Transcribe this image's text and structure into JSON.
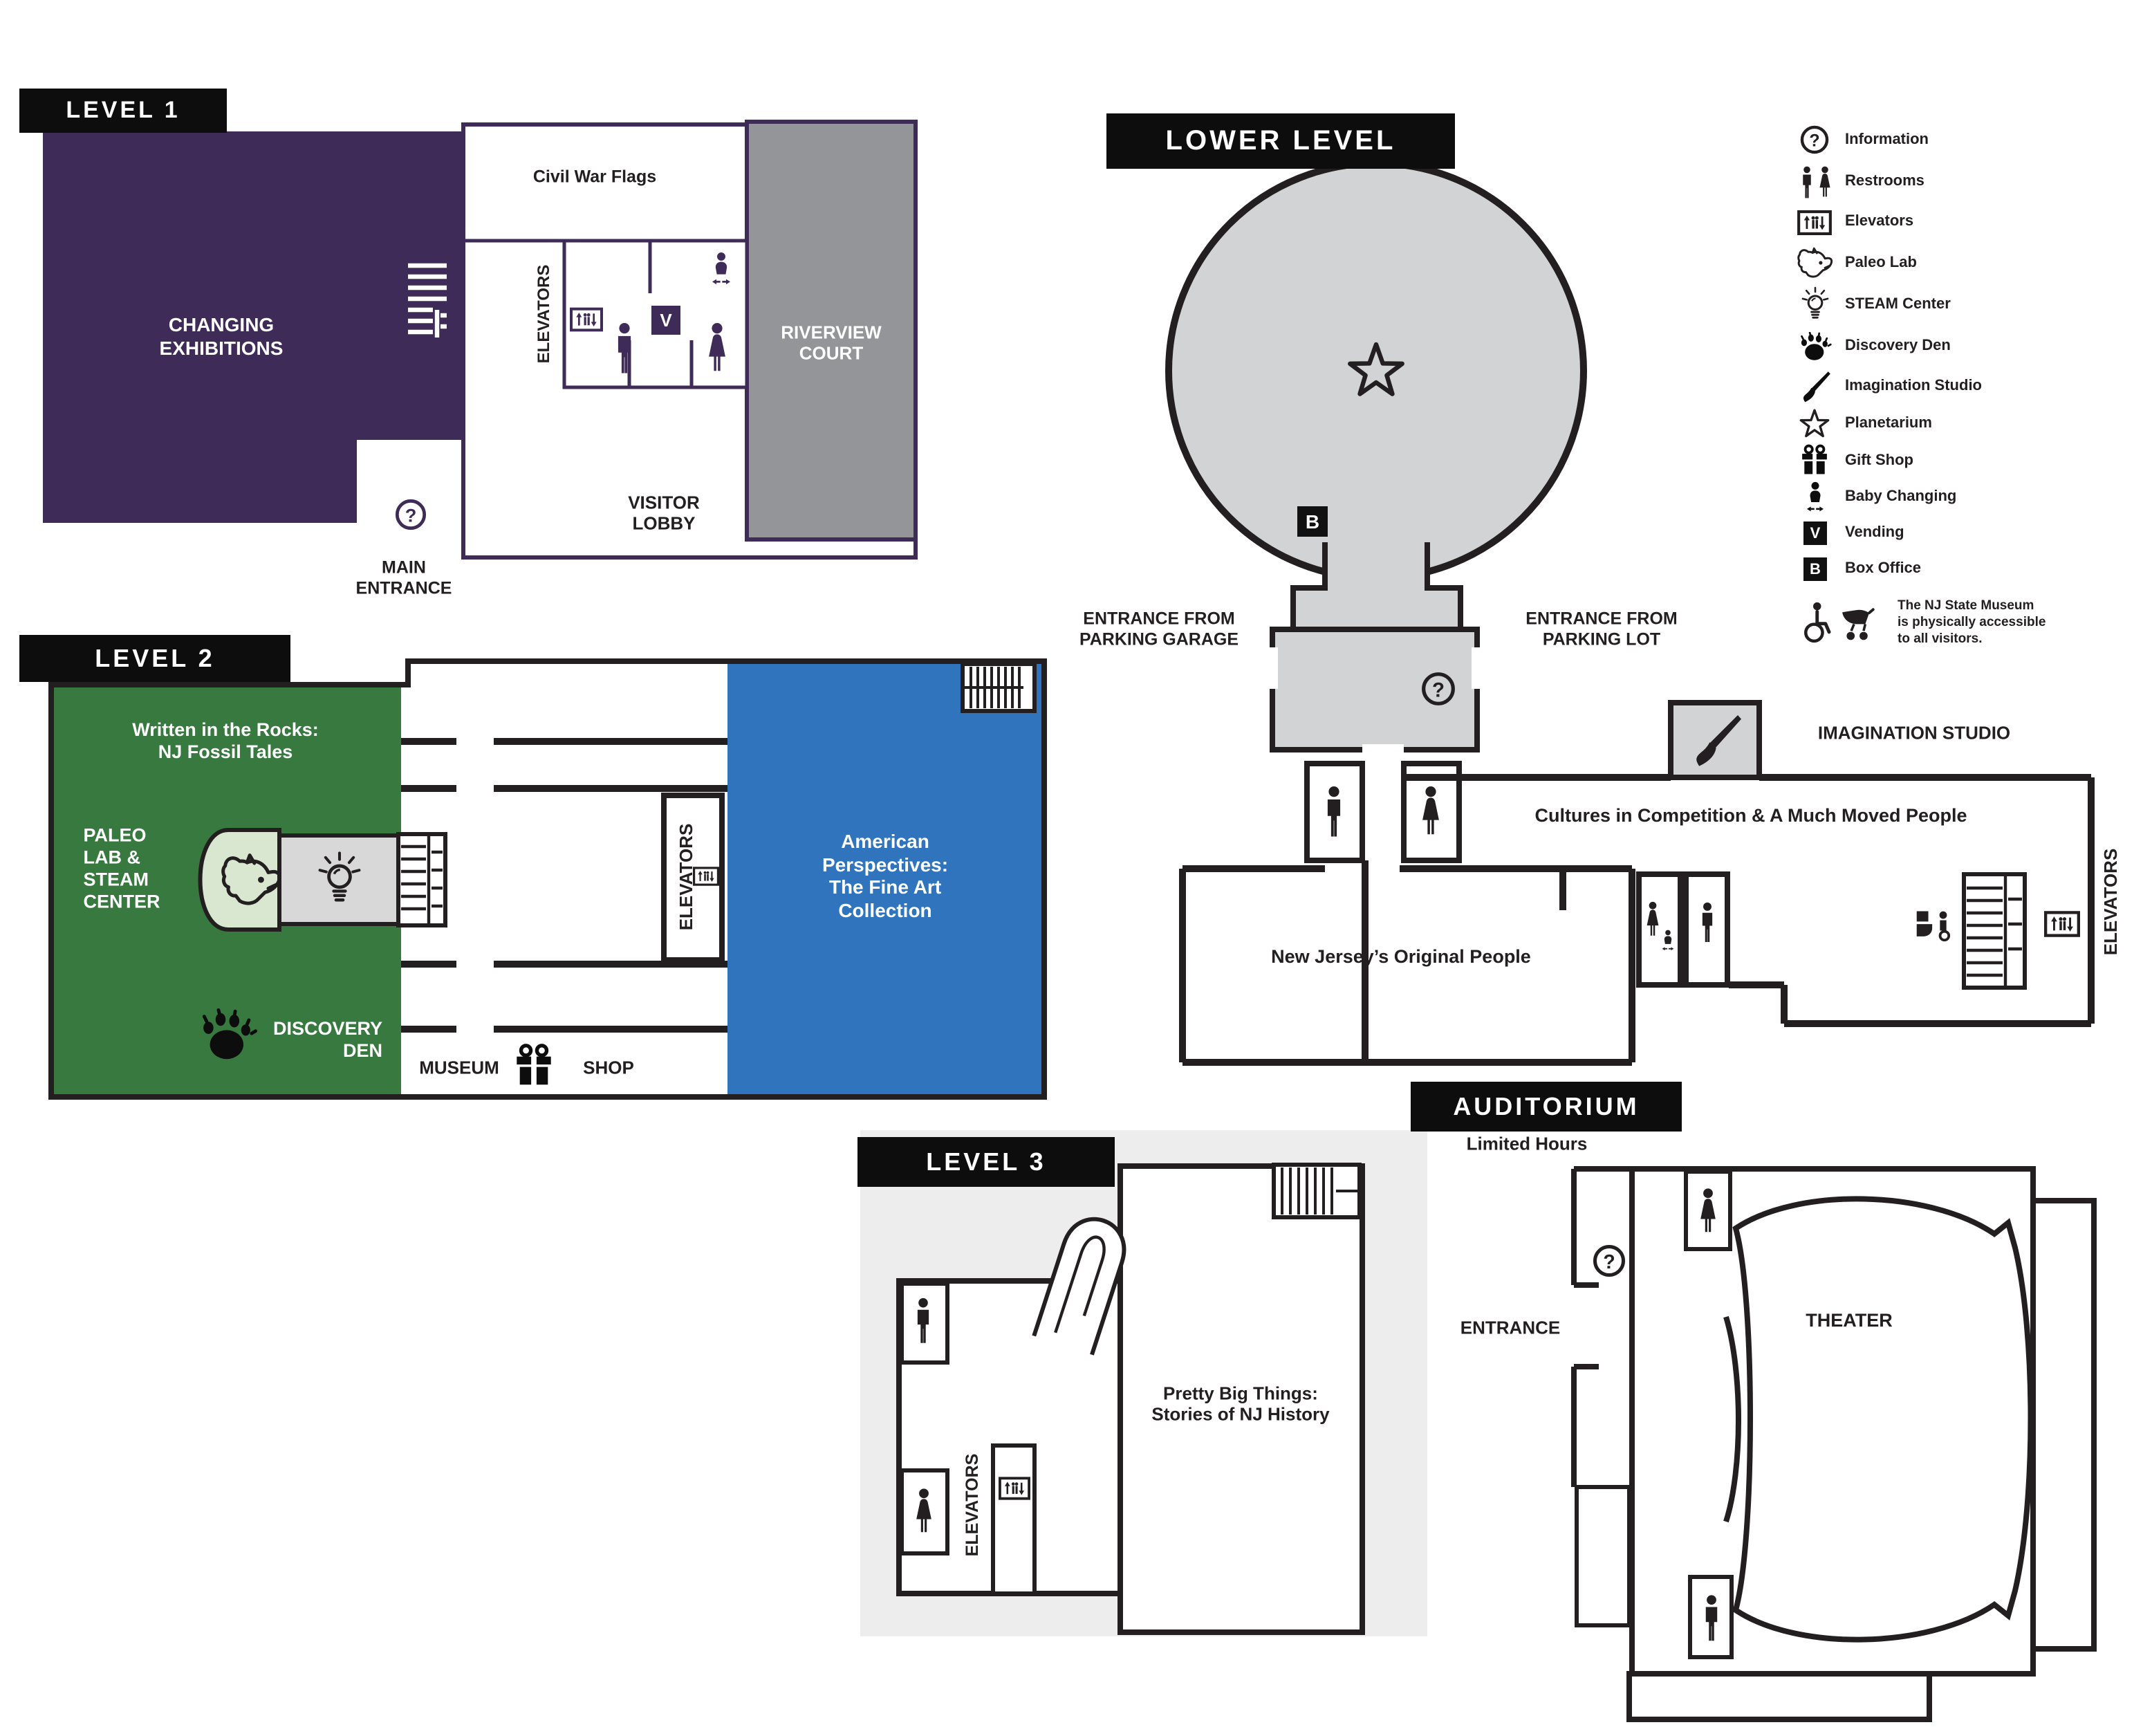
{
  "colors": {
    "purple": "#3F2B57",
    "green": "#37793F",
    "blue": "#2F74BC",
    "court_gray": "#949598",
    "light_gray": "#D2D3D4",
    "backdrop_gray": "#EDEDEE",
    "wall_black": "#231F20",
    "paleo_pill_green": "#D9E7D0",
    "steam_box_gray": "#D8D8D8"
  },
  "level1": {
    "title": "LEVEL 1",
    "changing_exhibitions": [
      "CHANGING",
      "EXHIBITIONS"
    ],
    "civil_war_flags": "Civil War Flags",
    "elevators": "ELEVATORS",
    "riverview_court": [
      "RIVERVIEW",
      "COURT"
    ],
    "visitor_lobby": [
      "VISITOR",
      "LOBBY"
    ],
    "main_entrance": [
      "MAIN",
      "ENTRANCE"
    ],
    "vending_letter": "V"
  },
  "level2": {
    "title": "LEVEL 2",
    "written_in_the_rocks": [
      "Written in the Rocks:",
      "NJ Fossil Tales"
    ],
    "paleo_lab_steam": [
      "PALEO",
      "LAB &",
      "STEAM",
      "CENTER"
    ],
    "discovery_den": [
      "DISCOVERY",
      "DEN"
    ],
    "museum": "MUSEUM",
    "shop": "SHOP",
    "elevators": "ELEVATORS",
    "american_perspectives": [
      "American",
      "Perspectives:",
      "The Fine Art",
      "Collection"
    ]
  },
  "lower_level": {
    "title": "LOWER LEVEL",
    "entrance_garage": [
      "ENTRANCE FROM",
      "PARKING GARAGE"
    ],
    "entrance_lot": [
      "ENTRANCE FROM",
      "PARKING LOT"
    ],
    "imagination_studio": "IMAGINATION STUDIO",
    "cultures": "Cultures in Competition & A Much Moved People",
    "nj_original_people": "New Jersey’s Original People",
    "elevators": "ELEVATORS",
    "box_office_letter": "B"
  },
  "level3": {
    "title": "LEVEL 3",
    "pretty_big_things": [
      "Pretty Big Things:",
      "Stories of NJ History"
    ],
    "elevators": "ELEVATORS"
  },
  "auditorium": {
    "title": "AUDITORIUM",
    "limited_hours": "Limited Hours",
    "entrance": "ENTRANCE",
    "theater": "THEATER"
  },
  "legend": {
    "items": [
      {
        "icon": "information-icon",
        "label": "Information"
      },
      {
        "icon": "restrooms-icon",
        "label": "Restrooms"
      },
      {
        "icon": "elevators-icon",
        "label": "Elevators"
      },
      {
        "icon": "paleo-lab-icon",
        "label": "Paleo Lab"
      },
      {
        "icon": "steam-center-icon",
        "label": "STEAM Center"
      },
      {
        "icon": "discovery-den-icon",
        "label": "Discovery Den"
      },
      {
        "icon": "imagination-studio-icon",
        "label": "Imagination Studio"
      },
      {
        "icon": "planetarium-icon",
        "label": "Planetarium"
      },
      {
        "icon": "gift-shop-icon",
        "label": "Gift Shop"
      },
      {
        "icon": "baby-changing-icon",
        "label": "Baby Changing"
      },
      {
        "icon": "vending-icon",
        "label": "Vending",
        "letter": "V"
      },
      {
        "icon": "box-office-icon",
        "label": "Box Office",
        "letter": "B"
      }
    ],
    "accessibility_note": [
      "The NJ State Museum",
      "is physically accessible",
      "to all visitors."
    ]
  }
}
